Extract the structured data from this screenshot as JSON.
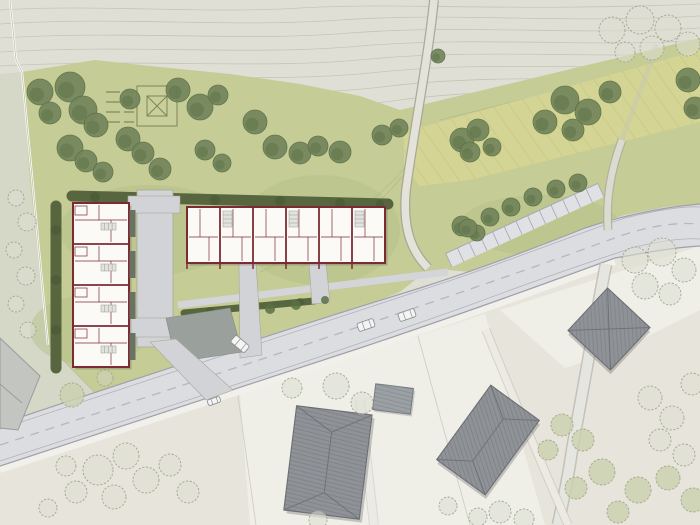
{
  "scene": {
    "kind": "architectural-site-plan",
    "view": "top-down plan rendering",
    "features": "terraced housing development on a meadow, main road with parking bay, farm track, existing hip-roof houses, tree planting, contour terrain"
  },
  "colors": {
    "paper": "#dfdfd6",
    "contour": "#c1c1b0",
    "outside_strip": "#d5d7c7",
    "meadow": "#c5cc96",
    "meadow_dark": "#b2bf86",
    "band_yellow": "#d5d693",
    "hedge": "#57663f",
    "tree_fill": "#74855c",
    "tree_dark": "#5a7045",
    "tree_light": "#ccd1af",
    "sketch_stroke": "#a2a594",
    "sketch_fill": "#dddfd0",
    "road_surface": "#dcdde1",
    "road_edge": "#a0a1a9",
    "road_marking": "#b6b7bf",
    "parking_surface": "#e0e1e4",
    "track_fill": "#e3e3da",
    "track_edge": "#a5a396",
    "path_gray": "#d2d3d6",
    "apron_gray": "#9aa09b",
    "wall_red": "#7d2b33",
    "floor_white": "#fbfaf7",
    "terrace_dark": "#6a7264",
    "roof_gray": "#8f9296",
    "roof_edge": "#6d7074",
    "annex_gray": "#9ba0a5",
    "light_roof": "#c3c5c1",
    "parcel_beige": "#e7e5db",
    "parcel_white": "#f0efe9",
    "car_body": "#f4f4f2",
    "car_line": "#8f9097"
  },
  "housing": {
    "row_west": {
      "x": 73,
      "y": 203,
      "w": 56,
      "unit_h": 41,
      "units": 4
    },
    "row_north": {
      "x": 187,
      "y": 207,
      "unit_w": 33,
      "h": 56,
      "units": 6
    }
  },
  "existing_buildings": [
    {
      "name": "hip-roof-house-south"
    },
    {
      "name": "flat-roof-annex-south"
    },
    {
      "name": "hip-roof-house-southeast"
    },
    {
      "name": "pyramid-roof-house-east"
    },
    {
      "name": "cut-house-west-edge"
    }
  ],
  "parking": {
    "x1": 452,
    "y1": 267,
    "x2": 604,
    "y2": 197,
    "stalls": 13,
    "depth": 15
  },
  "cars": [
    {
      "x": 366,
      "y": 325,
      "angle": -19,
      "l": 17,
      "w": 8.5
    },
    {
      "x": 407,
      "y": 315,
      "angle": -19,
      "l": 17,
      "w": 8.5
    },
    {
      "x": 214,
      "y": 401,
      "angle": -19,
      "l": 13,
      "w": 6
    },
    {
      "x": 240,
      "y": 344,
      "angle": 40,
      "l": 18,
      "w": 9
    }
  ],
  "garden_square": {
    "x": 137,
    "y": 86,
    "size": 40
  },
  "trees": {
    "filled": [
      [
        40,
        92,
        13
      ],
      [
        70,
        87,
        15
      ],
      [
        50,
        113,
        11
      ],
      [
        83,
        110,
        14
      ],
      [
        96,
        125,
        12
      ],
      [
        70,
        148,
        13
      ],
      [
        86,
        161,
        11
      ],
      [
        128,
        139,
        12
      ],
      [
        143,
        153,
        11
      ],
      [
        103,
        172,
        10
      ],
      [
        160,
        169,
        11
      ],
      [
        130,
        99,
        10
      ],
      [
        178,
        90,
        12
      ],
      [
        200,
        107,
        13
      ],
      [
        218,
        95,
        10
      ],
      [
        205,
        150,
        10
      ],
      [
        222,
        163,
        9
      ],
      [
        255,
        122,
        12
      ],
      [
        275,
        147,
        12
      ],
      [
        300,
        153,
        11
      ],
      [
        318,
        146,
        10
      ],
      [
        340,
        152,
        11
      ],
      [
        382,
        135,
        10
      ],
      [
        399,
        128,
        9
      ],
      [
        438,
        56,
        7
      ],
      [
        462,
        140,
        12
      ],
      [
        478,
        130,
        11
      ],
      [
        470,
        152,
        10
      ],
      [
        492,
        147,
        9
      ],
      [
        462,
        226,
        10
      ],
      [
        477,
        233,
        8
      ],
      [
        545,
        122,
        12
      ],
      [
        565,
        100,
        14
      ],
      [
        588,
        112,
        13
      ],
      [
        573,
        130,
        11
      ],
      [
        610,
        92,
        11
      ],
      [
        688,
        80,
        12
      ],
      [
        695,
        108,
        11
      ]
    ],
    "parking_row": [
      [
        468,
        228,
        9
      ],
      [
        490,
        217,
        9
      ],
      [
        511,
        207,
        9
      ],
      [
        533,
        197,
        9
      ],
      [
        556,
        189,
        9
      ],
      [
        578,
        183,
        9
      ]
    ],
    "sketch": [
      [
        612,
        30,
        13
      ],
      [
        640,
        20,
        14
      ],
      [
        668,
        28,
        13
      ],
      [
        652,
        48,
        12
      ],
      [
        688,
        44,
        12
      ],
      [
        625,
        52,
        10
      ],
      [
        635,
        260,
        13
      ],
      [
        662,
        252,
        14
      ],
      [
        684,
        270,
        12
      ],
      [
        645,
        286,
        13
      ],
      [
        670,
        294,
        11
      ],
      [
        16,
        198,
        8
      ],
      [
        27,
        222,
        9
      ],
      [
        14,
        250,
        8
      ],
      [
        26,
        276,
        9
      ],
      [
        16,
        304,
        8
      ],
      [
        28,
        330,
        8
      ],
      [
        98,
        470,
        15
      ],
      [
        126,
        456,
        13
      ],
      [
        146,
        480,
        13
      ],
      [
        114,
        497,
        12
      ],
      [
        76,
        492,
        11
      ],
      [
        66,
        466,
        10
      ],
      [
        170,
        465,
        11
      ],
      [
        188,
        492,
        11
      ],
      [
        48,
        508,
        9
      ],
      [
        292,
        388,
        10
      ],
      [
        336,
        386,
        13
      ],
      [
        362,
        403,
        11
      ],
      [
        318,
        520,
        9
      ],
      [
        500,
        512,
        11
      ],
      [
        524,
        519,
        10
      ],
      [
        478,
        517,
        9
      ],
      [
        448,
        506,
        9
      ],
      [
        650,
        398,
        12
      ],
      [
        672,
        418,
        12
      ],
      [
        692,
        384,
        11
      ],
      [
        660,
        440,
        11
      ],
      [
        684,
        455,
        11
      ]
    ],
    "light": [
      [
        602,
        472,
        13
      ],
      [
        638,
        490,
        13
      ],
      [
        668,
        478,
        12
      ],
      [
        693,
        500,
        12
      ],
      [
        618,
        512,
        11
      ],
      [
        583,
        440,
        11
      ],
      [
        562,
        425,
        11
      ],
      [
        548,
        450,
        10
      ],
      [
        576,
        488,
        11
      ],
      [
        72,
        395,
        12
      ],
      [
        105,
        378,
        8
      ]
    ],
    "bushes": [
      [
        270,
        309,
        5
      ],
      [
        296,
        305,
        5
      ],
      [
        325,
        300,
        4
      ]
    ]
  }
}
